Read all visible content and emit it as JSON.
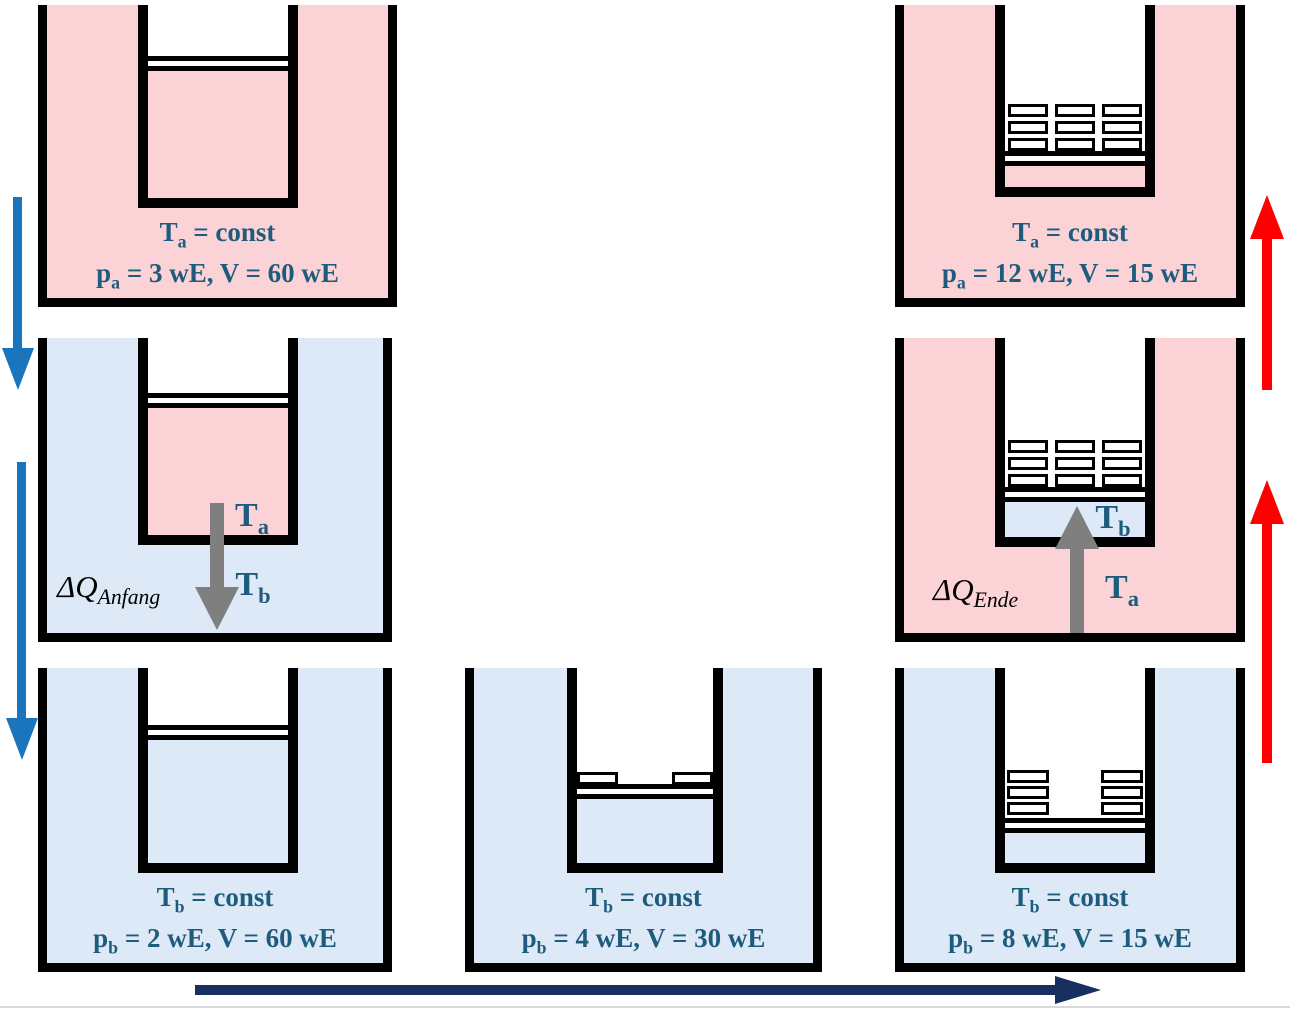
{
  "colors": {
    "hot_bath": "#fbd3d6",
    "cold_bath": "#dde9f6",
    "label_teal": "#1e5c7d",
    "arrow_gray": "#7f7f7f",
    "arrow_blue": "#1b75bc",
    "arrow_red": "#fe0000",
    "arrow_navy": "#17305f",
    "baseline_gray": "#d9d9d9"
  },
  "cells": {
    "top_left": {
      "t_base": "T",
      "t_sub": "a",
      "t_rest": " = const",
      "p_base": "p",
      "p_sub": "a",
      "p_rest": " = 3 wE, V = 60 wE"
    },
    "top_right": {
      "t_base": "T",
      "t_sub": "a",
      "t_rest": " = const",
      "p_base": "p",
      "p_sub": "a",
      "p_rest": " = 12 wE, V = 15 wE"
    },
    "bottom_left": {
      "t_base": "T",
      "t_sub": "b",
      "t_rest": " = const",
      "p_base": "p",
      "p_sub": "b",
      "p_rest": " = 2 wE, V = 60 wE"
    },
    "bottom_middle": {
      "t_base": "T",
      "t_sub": "b",
      "t_rest": " = const",
      "p_base": "p",
      "p_sub": "b",
      "p_rest": " = 4 wE, V = 30 wE"
    },
    "bottom_right": {
      "t_base": "T",
      "t_sub": "b",
      "t_rest": " = const",
      "p_base": "p",
      "p_sub": "b",
      "p_rest": " = 8 wE, V = 15 wE"
    }
  },
  "transfer_left": {
    "dq_base": "ΔQ",
    "dq_sub": "Anfang",
    "hot_label_base": "T",
    "hot_label_sub": "a",
    "cold_label_base": "T",
    "cold_label_sub": "b"
  },
  "transfer_right": {
    "dq_base": "ΔQ",
    "dq_sub": "Ende",
    "gas_label_base": "T",
    "gas_label_sub": "b",
    "bath_label_base": "T",
    "bath_label_sub": "a"
  }
}
